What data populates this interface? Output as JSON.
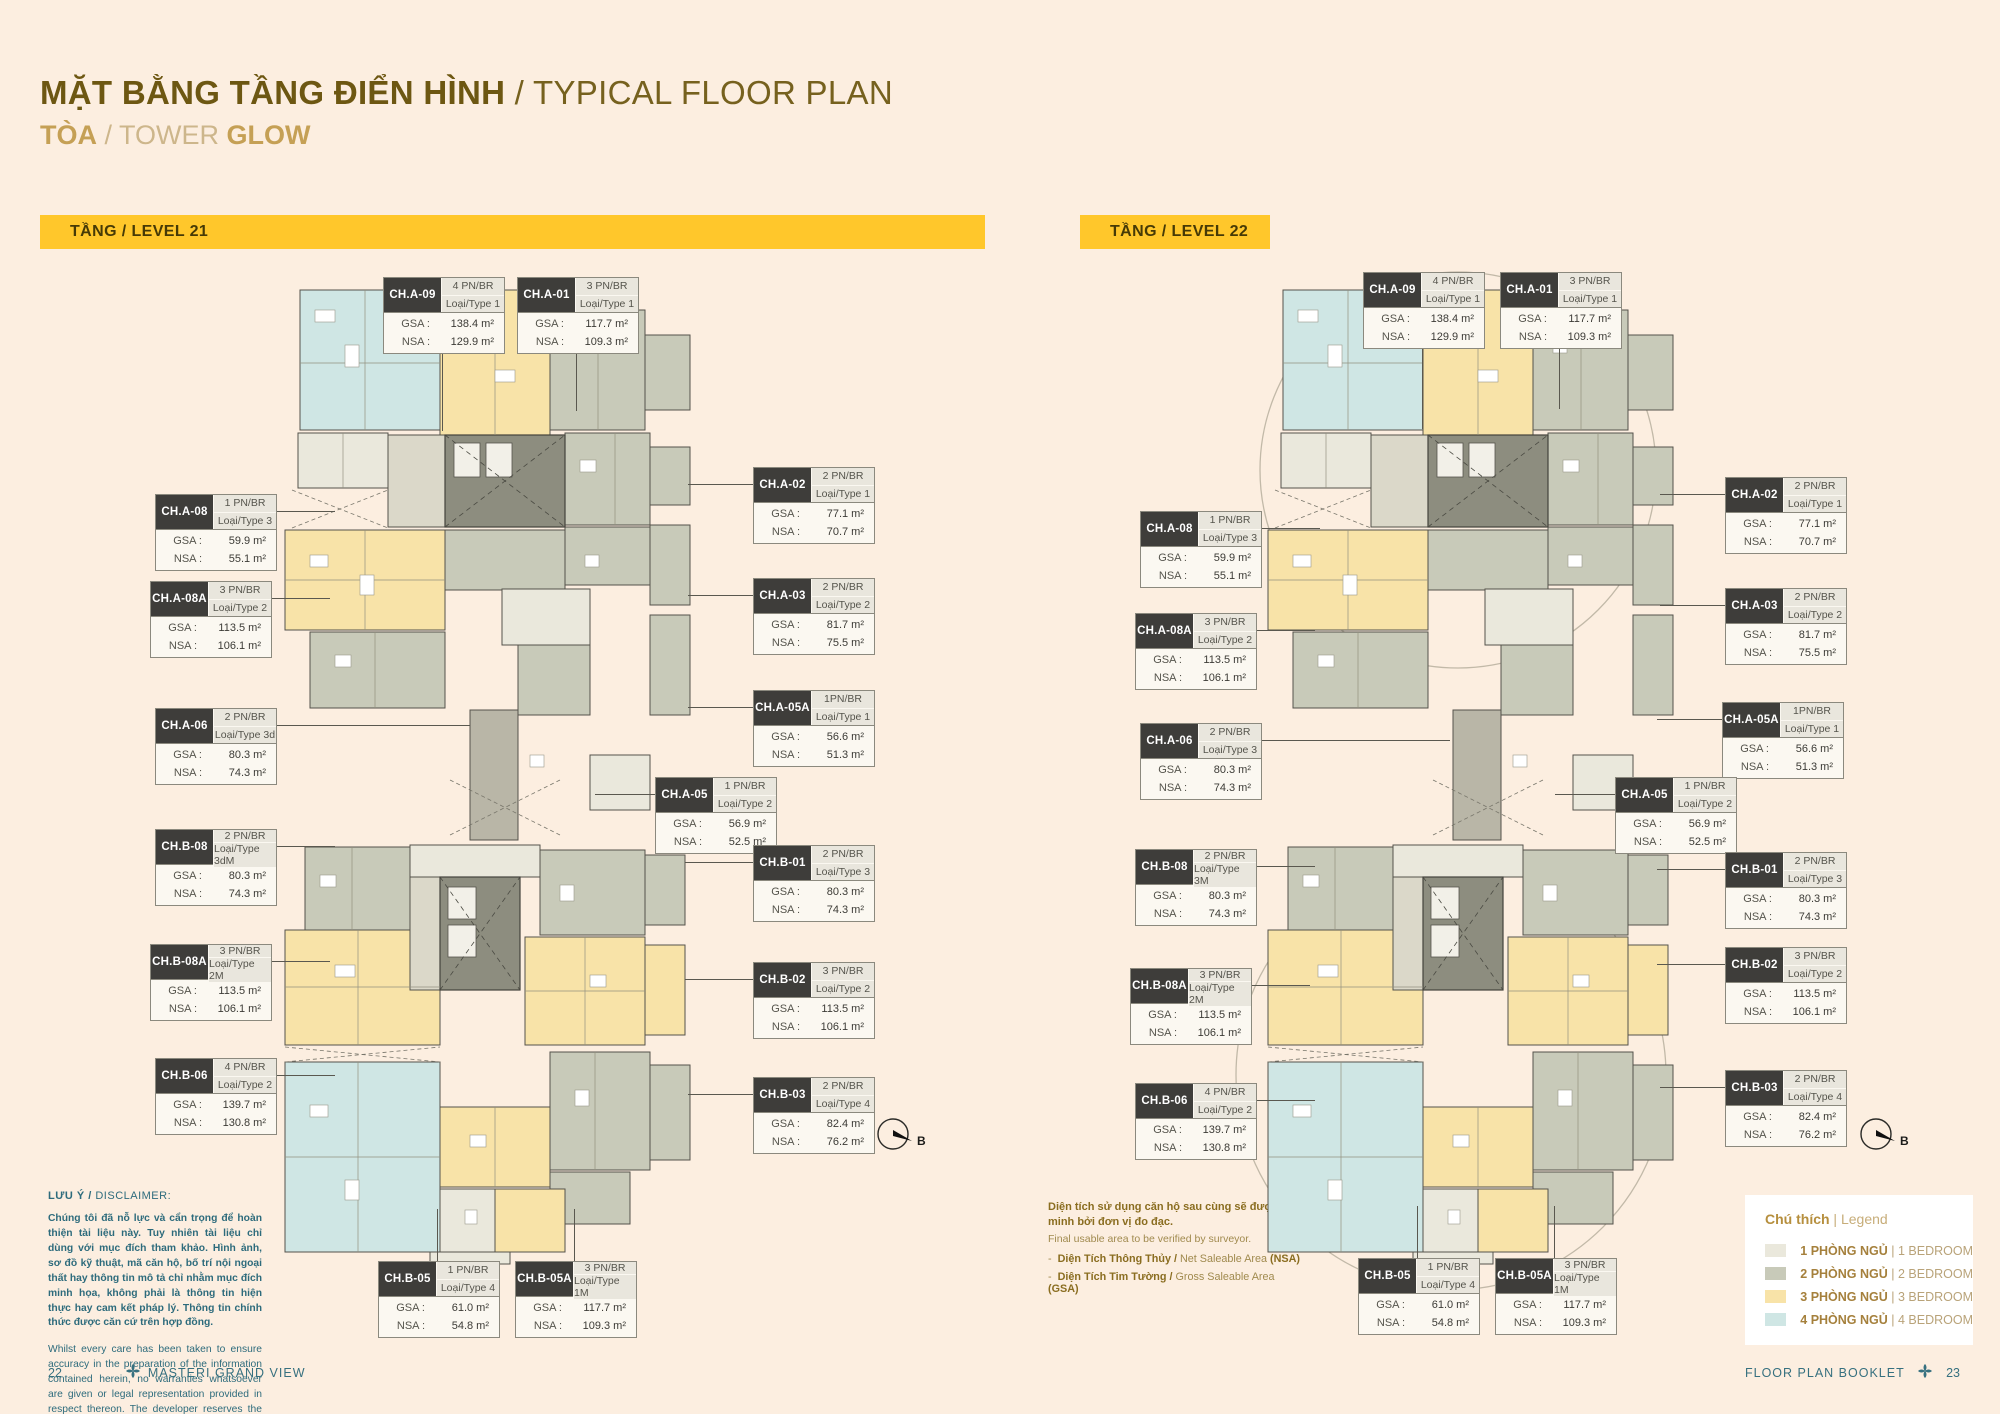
{
  "header": {
    "title_vi": "MẶT BẰNG TẦNG ĐIỂN HÌNH",
    "title_en": " / TYPICAL FLOOR PLAN",
    "subtitle_vi": "TÒA",
    "subtitle_mid": " / TOWER ",
    "tower_name": "GLOW"
  },
  "labels": {
    "gsa": "GSA :",
    "nsa": "NSA :"
  },
  "colors": {
    "banner": "#ffc72b",
    "legend_1br": "#eae8dc",
    "legend_2br": "#c8cab9",
    "legend_3br": "#f8e3a8",
    "legend_4br": "#cfe6e4"
  },
  "levels": [
    {
      "banner": "TẦNG / LEVEL 21",
      "compass_label": "B",
      "units": [
        {
          "code": "CH.A-09",
          "bed": "4 PN/BR",
          "type": "Loại/Type 1",
          "gsa": "138.4 m²",
          "nsa": "129.9 m²"
        },
        {
          "code": "CH.A-01",
          "bed": "3 PN/BR",
          "type": "Loại/Type 1",
          "gsa": "117.7 m²",
          "nsa": "109.3 m²"
        },
        {
          "code": "CH.A-08",
          "bed": "1 PN/BR",
          "type": "Loại/Type 3",
          "gsa": "59.9 m²",
          "nsa": "55.1 m²"
        },
        {
          "code": "CH.A-08A",
          "bed": "3 PN/BR",
          "type": "Loại/Type 2",
          "gsa": "113.5 m²",
          "nsa": "106.1 m²"
        },
        {
          "code": "CH.A-06",
          "bed": "2 PN/BR",
          "type": "Loại/Type 3d",
          "gsa": "80.3 m²",
          "nsa": "74.3 m²"
        },
        {
          "code": "CH.B-08",
          "bed": "2 PN/BR",
          "type": "Loại/Type 3dM",
          "gsa": "80.3 m²",
          "nsa": "74.3 m²"
        },
        {
          "code": "CH.B-08A",
          "bed": "3 PN/BR",
          "type": "Loại/Type 2M",
          "gsa": "113.5 m²",
          "nsa": "106.1 m²"
        },
        {
          "code": "CH.B-06",
          "bed": "4 PN/BR",
          "type": "Loại/Type 2",
          "gsa": "139.7 m²",
          "nsa": "130.8 m²"
        },
        {
          "code": "CH.A-02",
          "bed": "2 PN/BR",
          "type": "Loại/Type 1",
          "gsa": "77.1 m²",
          "nsa": "70.7 m²"
        },
        {
          "code": "CH.A-03",
          "bed": "2 PN/BR",
          "type": "Loại/Type 2",
          "gsa": "81.7 m²",
          "nsa": "75.5 m²"
        },
        {
          "code": "CH.A-05A",
          "bed": "1PN/BR",
          "type": "Loại/Type 1",
          "gsa": "56.6 m²",
          "nsa": "51.3 m²"
        },
        {
          "code": "CH.A-05",
          "bed": "1 PN/BR",
          "type": "Loại/Type 2",
          "gsa": "56.9 m²",
          "nsa": "52.5 m²"
        },
        {
          "code": "CH.B-01",
          "bed": "2 PN/BR",
          "type": "Loại/Type 3",
          "gsa": "80.3 m²",
          "nsa": "74.3 m²"
        },
        {
          "code": "CH.B-02",
          "bed": "3 PN/BR",
          "type": "Loại/Type 2",
          "gsa": "113.5 m²",
          "nsa": "106.1 m²"
        },
        {
          "code": "CH.B-03",
          "bed": "2 PN/BR",
          "type": "Loại/Type 4",
          "gsa": "82.4 m²",
          "nsa": "76.2 m²"
        },
        {
          "code": "CH.B-05",
          "bed": "1 PN/BR",
          "type": "Loại/Type 4",
          "gsa": "61.0 m²",
          "nsa": "54.8 m²"
        },
        {
          "code": "CH.B-05A",
          "bed": "3 PN/BR",
          "type": "Loại/Type 1M",
          "gsa": "117.7 m²",
          "nsa": "109.3 m²"
        }
      ]
    },
    {
      "banner": "TẦNG / LEVEL 22",
      "compass_label": "B",
      "units": [
        {
          "code": "CH.A-09",
          "bed": "4 PN/BR",
          "type": "Loại/Type 1",
          "gsa": "138.4 m²",
          "nsa": "129.9 m²"
        },
        {
          "code": "CH.A-01",
          "bed": "3 PN/BR",
          "type": "Loại/Type 1",
          "gsa": "117.7 m²",
          "nsa": "109.3 m²"
        },
        {
          "code": "CH.A-08",
          "bed": "1 PN/BR",
          "type": "Loại/Type 3",
          "gsa": "59.9 m²",
          "nsa": "55.1 m²"
        },
        {
          "code": "CH.A-08A",
          "bed": "3 PN/BR",
          "type": "Loại/Type 2",
          "gsa": "113.5 m²",
          "nsa": "106.1 m²"
        },
        {
          "code": "CH.A-06",
          "bed": "2 PN/BR",
          "type": "Loại/Type 3",
          "gsa": "80.3 m²",
          "nsa": "74.3 m²"
        },
        {
          "code": "CH.B-08",
          "bed": "2 PN/BR",
          "type": "Loại/Type 3M",
          "gsa": "80.3 m²",
          "nsa": "74.3 m²"
        },
        {
          "code": "CH.B-08A",
          "bed": "3 PN/BR",
          "type": "Loại/Type 2M",
          "gsa": "113.5 m²",
          "nsa": "106.1 m²"
        },
        {
          "code": "CH.B-06",
          "bed": "4 PN/BR",
          "type": "Loại/Type 2",
          "gsa": "139.7 m²",
          "nsa": "130.8 m²"
        },
        {
          "code": "CH.A-02",
          "bed": "2 PN/BR",
          "type": "Loại/Type 1",
          "gsa": "77.1 m²",
          "nsa": "70.7 m²"
        },
        {
          "code": "CH.A-03",
          "bed": "2 PN/BR",
          "type": "Loại/Type 2",
          "gsa": "81.7 m²",
          "nsa": "75.5 m²"
        },
        {
          "code": "CH.A-05A",
          "bed": "1PN/BR",
          "type": "Loại/Type 1",
          "gsa": "56.6 m²",
          "nsa": "51.3 m²"
        },
        {
          "code": "CH.A-05",
          "bed": "1 PN/BR",
          "type": "Loại/Type 2",
          "gsa": "56.9 m²",
          "nsa": "52.5 m²"
        },
        {
          "code": "CH.B-01",
          "bed": "2 PN/BR",
          "type": "Loại/Type 3",
          "gsa": "80.3 m²",
          "nsa": "74.3 m²"
        },
        {
          "code": "CH.B-02",
          "bed": "3 PN/BR",
          "type": "Loại/Type 2",
          "gsa": "113.5 m²",
          "nsa": "106.1 m²"
        },
        {
          "code": "CH.B-03",
          "bed": "2 PN/BR",
          "type": "Loại/Type 4",
          "gsa": "82.4 m²",
          "nsa": "76.2 m²"
        },
        {
          "code": "CH.B-05",
          "bed": "1 PN/BR",
          "type": "Loại/Type 4",
          "gsa": "61.0 m²",
          "nsa": "54.8 m²"
        },
        {
          "code": "CH.B-05A",
          "bed": "3 PN/BR",
          "type": "Loại/Type 1M",
          "gsa": "117.7 m²",
          "nsa": "109.3 m²"
        }
      ]
    }
  ],
  "disclaimer": {
    "heading_vi": "LƯU Ý /",
    "heading_en": " DISCLAIMER:",
    "body_vi": "Chúng tôi đã nỗ lực và cẩn trọng để hoàn thiện tài liệu này. Tuy nhiên tài liệu chỉ dùng với mục đích tham khảo. Hình ảnh, sơ đồ kỹ thuật, mã căn hộ, bố trí nội ngoại thất hay thông tin mô tả chỉ nhằm mục đích minh họa, không phải là thông tin hiện thực hay cam kết pháp lý. Thông tin chính thức được căn cứ trên hợp đồng.",
    "body_en": "Whilst every care has been taken to ensure accuracy in the preparation of the information contained herein, no warranties whatsoever are given or legal representation provided in respect thereon. The developer reserves the right to modify information of the development or any part thereof as maybe approved or required by the relevant authorities."
  },
  "notes": {
    "vi": "Diện tích sử dụng căn hộ sau cùng sẽ được xác minh bởi đơn vị đo đạc.",
    "en": "Final usable area to be verified by surveyor.",
    "bullets": [
      {
        "vi": "Diện Tích Thông Thủy /",
        "en": " Net Saleable Area ",
        "abbr": "(NSA)"
      },
      {
        "vi": "Diện Tích Tim Tường /",
        "en": " Gross Saleable Area ",
        "abbr": "(GSA)"
      }
    ]
  },
  "legend": {
    "title_vi": "Chú thích",
    "title_sep": " | ",
    "title_en": "Legend",
    "rows": [
      {
        "vi": "1 PHÒNG NGỦ",
        "sep": " | ",
        "en": "1 BEDROOM",
        "color_key": "legend_1br"
      },
      {
        "vi": "2 PHÒNG NGỦ",
        "sep": " | ",
        "en": "2 BEDROOM",
        "color_key": "legend_2br"
      },
      {
        "vi": "3 PHÒNG NGỦ",
        "sep": " | ",
        "en": "3 BEDROOM",
        "color_key": "legend_3br"
      },
      {
        "vi": "4 PHÒNG NGỦ",
        "sep": " | ",
        "en": "4 BEDROOM",
        "color_key": "legend_4br"
      }
    ]
  },
  "footer": {
    "left_page": "22",
    "left_brand": "MASTERI GRAND VIEW",
    "right_label": "FLOOR PLAN BOOKLET",
    "right_page": "23"
  }
}
